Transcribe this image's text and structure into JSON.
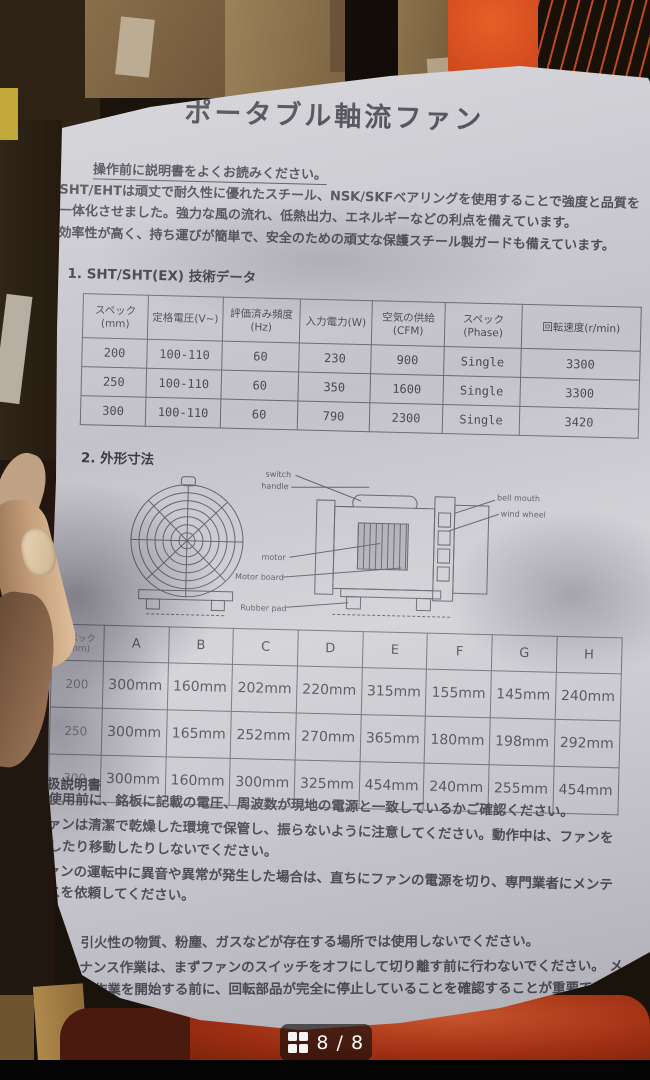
{
  "viewer": {
    "pager_text": "8 / 8"
  },
  "colors": {
    "paper": "#cfced4",
    "ink": "#3c3b44",
    "accent_orange": "#cf4a1d",
    "plastic_red": "#9e2e12",
    "badge_bg": "rgba(12,12,12,0.62)"
  },
  "doc": {
    "title": "ポータブル軸流ファン",
    "notice": "操作前に説明書をよくお読みください。",
    "intro1": "SHT/EHTは頑丈で耐久性に優れたスチール、NSK/SKFベアリングを使用することで強度と品質を一体化させました。強力な風の流れ、低熱出力、エネルギーなどの利点を備えています。",
    "intro2": "効率性が高く、持ち運びが簡単で、安全のための頑丈な保護スチール製ガードも備えています。",
    "section1_title": "1. SHT/SHT(EX) 技術データ",
    "tech_table": {
      "headers": [
        "スペック(mm)",
        "定格電圧(V~)",
        "評価済み頻度 (Hz)",
        "入力電力(W)",
        "空気の供給(CFM)",
        "スペック (Phase)",
        "回転速度(r/min)"
      ],
      "rows": [
        [
          "200",
          "100-110",
          "60",
          "230",
          "900",
          "Single",
          "3300"
        ],
        [
          "250",
          "100-110",
          "60",
          "350",
          "1600",
          "Single",
          "3300"
        ],
        [
          "300",
          "100-110",
          "60",
          "790",
          "2300",
          "Single",
          "3420"
        ]
      ]
    },
    "section2_title": "2. 外形寸法",
    "diagram": {
      "labels": {
        "switch": "switch",
        "handle": "handle",
        "bell_mouth": "bell mouth",
        "wind_wheel": "wind wheel",
        "motor": "motor",
        "motor_board": "Motor board",
        "rubber_pad": "Rubber pad"
      }
    },
    "dim_table": {
      "headers": [
        "スペック(mm)",
        "A",
        "B",
        "C",
        "D",
        "E",
        "F",
        "G",
        "H"
      ],
      "rows": [
        [
          "200",
          "300mm",
          "160mm",
          "202mm",
          "220mm",
          "315mm",
          "155mm",
          "145mm",
          "240mm"
        ],
        [
          "250",
          "300mm",
          "165mm",
          "252mm",
          "270mm",
          "365mm",
          "180mm",
          "198mm",
          "292mm"
        ],
        [
          "300",
          "300mm",
          "160mm",
          "300mm",
          "325mm",
          "454mm",
          "240mm",
          "255mm",
          "454mm"
        ]
      ]
    },
    "section3_title": "3.取扱説明書",
    "bullets": [
      "ご使用前に、銘板に記載の電圧、周波数が現地の電源と一致しているかご確認ください。",
      "ファンは清潔で乾燥した環境で保管し、振らないように注意してください。動作中は、ファンを調整したり移動したりしないでください。",
      "ファンの運転中に異音や異常が発生した場合は、直ちにファンの電源を切り、専門業者にメンテナンスを依頼してください。"
    ],
    "warning1": "爆発性、引火性の物質、粉塵、ガスなどが存在する場所では使用しないでください。",
    "warning2": "メンテナンス作業は、まずファンのスイッチをオフにして切り離す前に行わないでください。 メンテナンス作業を開始する前に、回転部品が完全に停止していることを確認することが重要です。"
  }
}
